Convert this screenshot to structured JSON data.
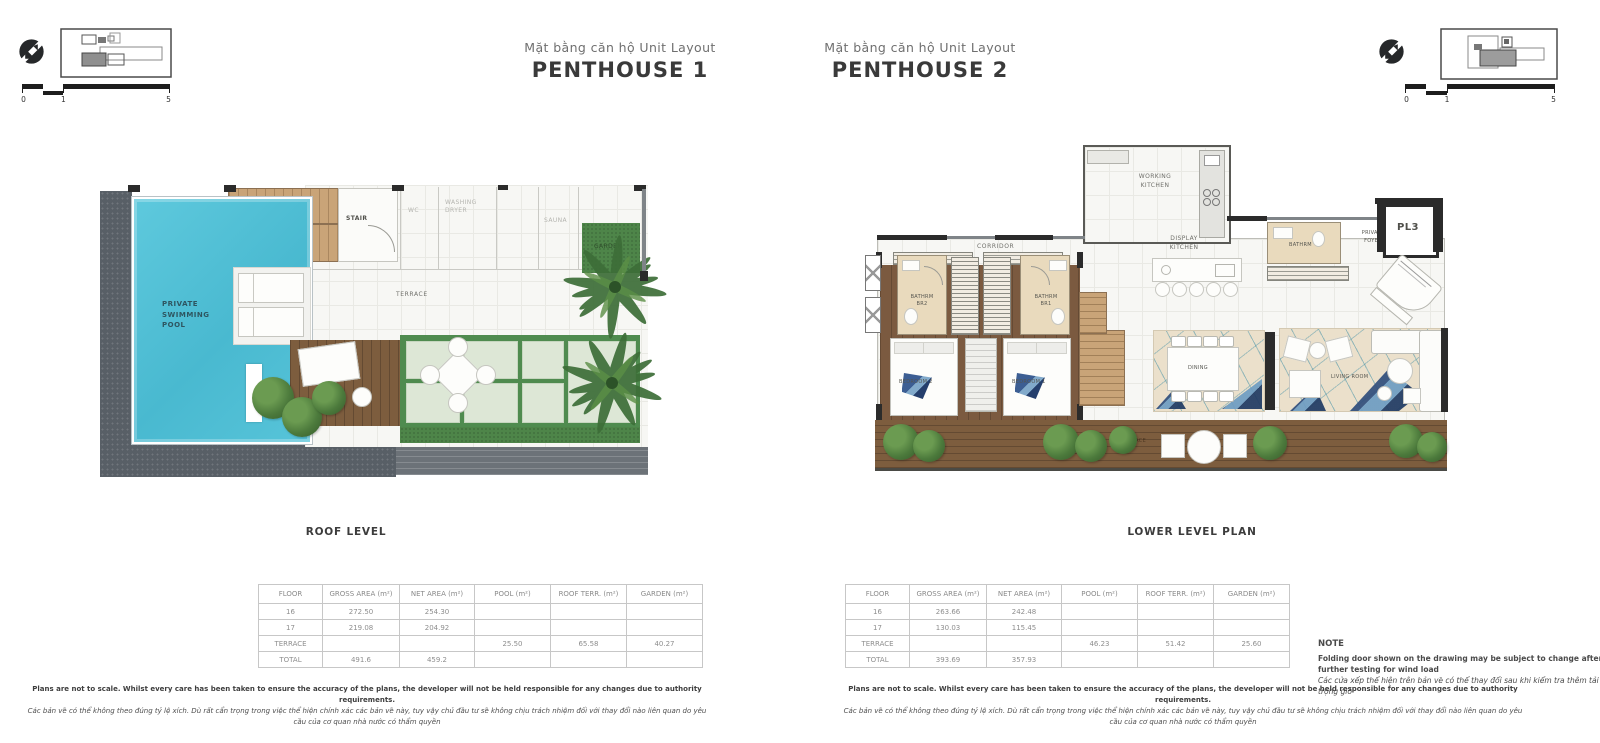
{
  "header": {
    "penthouse1": {
      "subtitle": "Mặt bằng căn hộ Unit Layout",
      "title": "PENTHOUSE 1"
    },
    "penthouse2": {
      "subtitle": "Mặt bằng căn hộ Unit Layout",
      "title": "PENTHOUSE 2"
    },
    "scale": {
      "t0": "0",
      "t1": "1",
      "t5": "5"
    }
  },
  "plan1": {
    "caption": "ROOF LEVEL",
    "labels": {
      "pool": "PRIVATE SWIMMING POOL",
      "stair": "STAIR",
      "terrace": "TERRACE",
      "garden": "GARDEN",
      "wc": "WC",
      "washing_dryer": "WASHING DRYER",
      "sauna": "SAUNA"
    }
  },
  "plan2": {
    "caption": "LOWER LEVEL PLAN",
    "labels": {
      "working_kitchen": "WORKING KITCHEN",
      "display_kitchen": "DISPLAY KITCHEN",
      "corridor": "CORRIDOR",
      "bathrm_br2": "BATHRM BR2",
      "bathrm_br1": "BATHRM BR1",
      "bedroom2": "BEDROOM 2",
      "bedroom1": "BEDROOM 1",
      "dining": "DINING",
      "living_room": "LIVING ROOM",
      "bathrm": "BATHRM",
      "private_foyer": "PRIVATE FOYER",
      "elevator": "PL3",
      "terrace": "TERRACE"
    }
  },
  "area_table1": {
    "headers": [
      "FLOOR",
      "GROSS AREA (m²)",
      "NET AREA (m²)",
      "POOL (m²)",
      "ROOF TERR. (m²)",
      "GARDEN (m²)"
    ],
    "rows": [
      [
        "16",
        "272.50",
        "254.30",
        "",
        "",
        ""
      ],
      [
        "17",
        "219.08",
        "204.92",
        "",
        "",
        ""
      ],
      [
        "TERRACE",
        "",
        "",
        "25.50",
        "65.58",
        "40.27"
      ],
      [
        "TOTAL",
        "491.6",
        "459.2",
        "",
        "",
        ""
      ]
    ]
  },
  "area_table2": {
    "headers": [
      "FLOOR",
      "GROSS AREA (m²)",
      "NET AREA (m²)",
      "POOL (m²)",
      "ROOF TERR. (m²)",
      "GARDEN (m²)"
    ],
    "rows": [
      [
        "16",
        "263.66",
        "242.48",
        "",
        "",
        ""
      ],
      [
        "17",
        "130.03",
        "115.45",
        "",
        "",
        ""
      ],
      [
        "TERRACE",
        "",
        "",
        "46.23",
        "51.42",
        "25.60"
      ],
      [
        "TOTAL",
        "393.69",
        "357.93",
        "",
        "",
        ""
      ]
    ]
  },
  "note": {
    "title": "NOTE",
    "en": "Folding door shown on the drawing may be subject to change after further testing for wind load",
    "vi": "Các cửa xếp thể hiện trên bản vẽ có thể thay đổi sau khi kiểm tra thêm tải trọng gió"
  },
  "disclaimer": {
    "en": "Plans are not to scale. Whilst every care has been taken to ensure the accuracy of the plans, the developer will not be held responsible for any changes due to authority requirements.",
    "vi": "Các bản vẽ có thể không theo đúng tỷ lệ xích. Dù rất cẩn trọng trong việc thể hiện chính xác các bản vẽ này, tuy vậy chủ đầu tư sẽ không chịu trách nhiệm đối với thay đổi nào liên quan do yêu cầu của cơ quan nhà nước có thẩm quyền"
  },
  "colors": {
    "pool_blue": "#4fc0d6",
    "stone_deck": "#585f66",
    "stair_wood": "#c9a478",
    "bedroom_wood": "#7b5a40",
    "balcony_wood": "#7d5d3e",
    "garden_green": "#4f8b4f",
    "rug_beige": "#ebe0cb",
    "rug_navy": "#2f4d7c",
    "bath_beige": "#e9dabd"
  }
}
